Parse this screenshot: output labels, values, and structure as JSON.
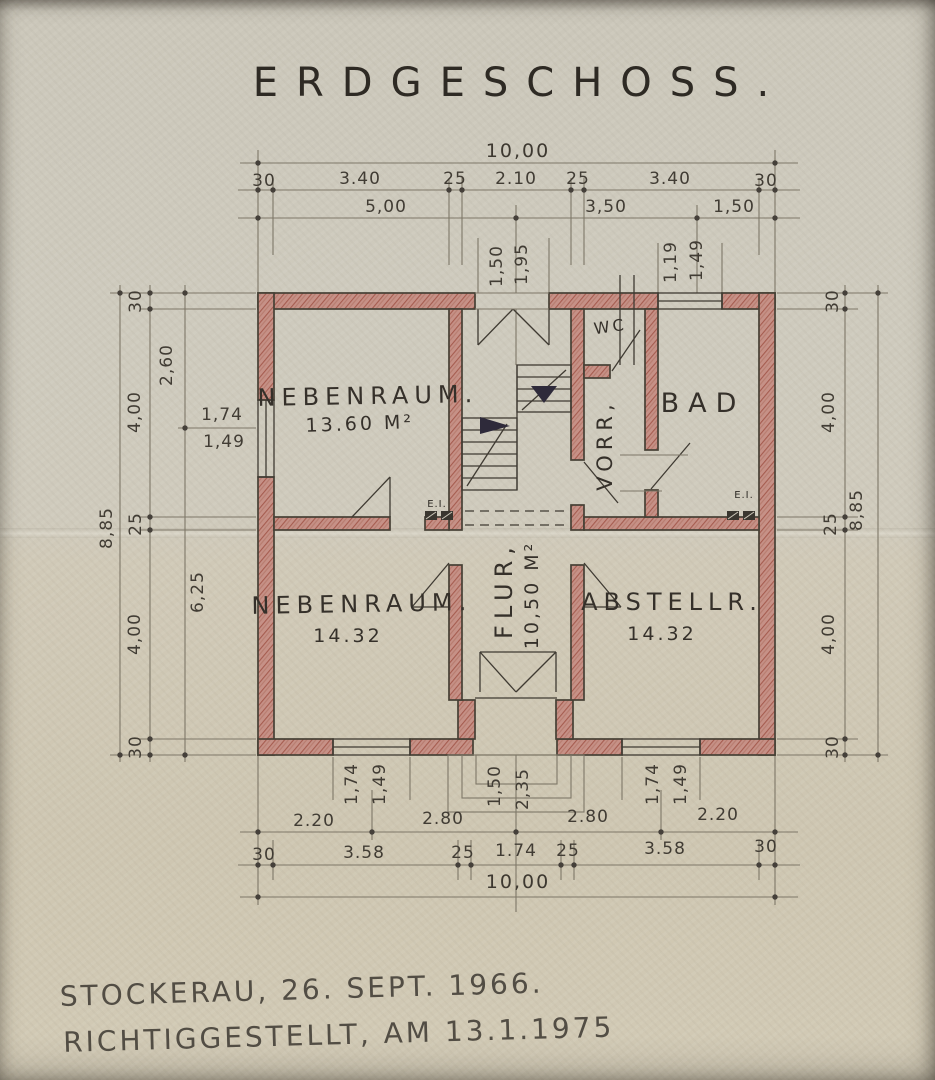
{
  "title": "ERDGESCHOSS.",
  "footer": {
    "line1": "STOCKERAU, 26. SEPT. 1966.",
    "line2": "RICHTIGGESTELLT, AM 13.1.1975"
  },
  "rooms": {
    "nebenraum_top": {
      "name": "NEBENRAUM.",
      "area": "13.60 M²"
    },
    "nebenraum_bottom": {
      "name": "NEBENRAUM.",
      "area": "14.32"
    },
    "flur": {
      "name": "FLUR,",
      "area": "10,50 M²"
    },
    "abstellraum": {
      "name": "ABSTELLR.",
      "area": "14.32"
    },
    "bad": {
      "name": "BAD"
    },
    "vorraum": {
      "name": "VORR,"
    },
    "wc": {
      "name": "WC"
    },
    "ei": "E.I."
  },
  "dims": {
    "top_overall": "10,00",
    "top_chain": [
      "30",
      "3.40",
      "25",
      "2.10",
      "25",
      "3.40",
      "30"
    ],
    "top_sub": [
      "5,00",
      "3,50",
      "1,50"
    ],
    "rear_door": [
      "1,50",
      "1,95"
    ],
    "bad_window": [
      "1,19",
      "1,49"
    ],
    "left_overall": "8,85",
    "left_chain": [
      "30",
      "4,00",
      "25",
      "4,00",
      "30"
    ],
    "left_inner": [
      "2,60",
      "6,25"
    ],
    "left_window": [
      "1,74",
      "1,49"
    ],
    "right_overall": "8,85",
    "right_chain": [
      "30",
      "4,00",
      "25",
      "4,00",
      "30"
    ],
    "bottom_sub": [
      "2.20",
      "2.80",
      "2.80",
      "2.20"
    ],
    "bottom_chain": [
      "30",
      "3.58",
      "25",
      "1.74",
      "25",
      "3.58",
      "30"
    ],
    "bottom_overall": "10,00",
    "bottom_window_left": [
      "1,74",
      "1,49"
    ],
    "bottom_window_right": [
      "1,74",
      "1,49"
    ],
    "entry_steps": [
      "1,50",
      "2,35"
    ]
  },
  "colors": {
    "paper": "#cfcabc",
    "wall_red": "#c69187",
    "wall_hatch": "#a55c4f",
    "ink": "#3f3a32",
    "pencil": "#7e7768"
  }
}
